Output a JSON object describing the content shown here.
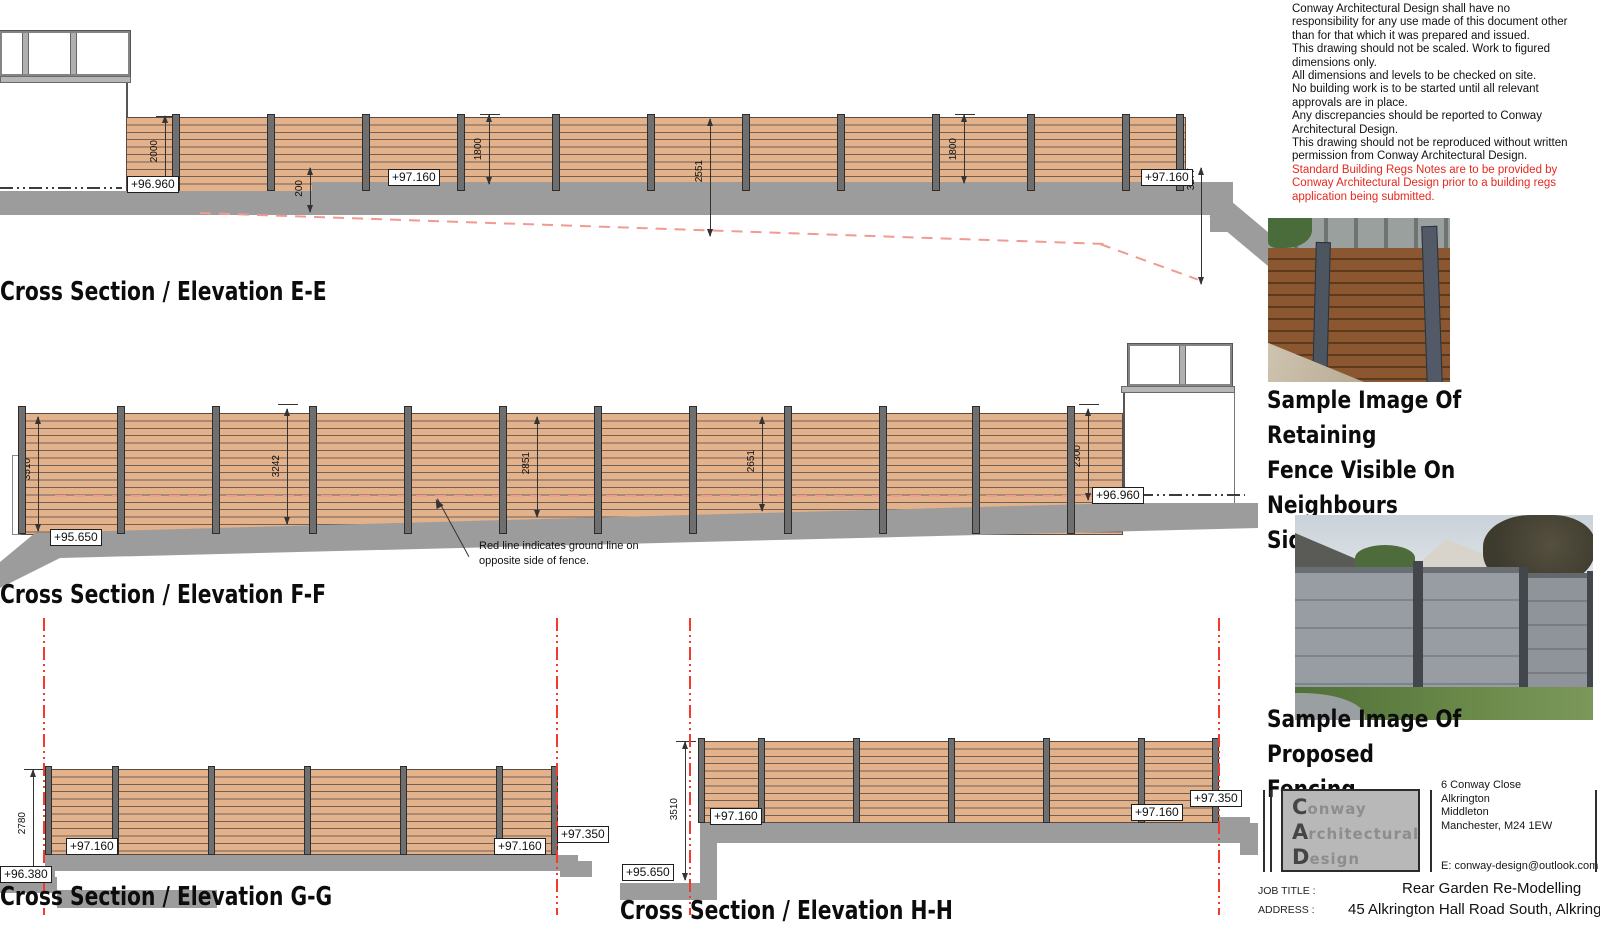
{
  "notes": {
    "disclaimer": "Conway Architectural Design shall have no\nresponsibility for any use made of this document other\nthan for that which it was prepared and issued.\nThis drawing should not be scaled. Work to figured\ndimensions only.\nAll dimensions and levels to be checked on site.\nNo building work is to be started until all relevant\napprovals are in place.\nAny discrepancies should be reported to Conway\nArchitectural Design.\nThis drawing should not be reproduced without written\npermission from Conway Architectural Design.",
    "building_regs": "Standard Building Regs Notes are to be provided by\nConway Architectural Design prior to a building regs\napplication being submitted."
  },
  "sections": [
    {
      "id": "E-E",
      "title": "Cross Section / Elevation E-E",
      "dims": [
        "2000",
        "200",
        "1800",
        "2551",
        "1800",
        "3277"
      ],
      "levels": [
        "+96.960",
        "+97.160",
        "+97.160"
      ]
    },
    {
      "id": "F-F",
      "title": "Cross Section / Elevation F-F",
      "dims": [
        "3510",
        "3242",
        "2851",
        "2651",
        "2300"
      ],
      "levels": [
        "+95.650",
        "+96.960"
      ],
      "note": "Red line indicates ground line on\nopposite side of fence."
    },
    {
      "id": "G-G",
      "title": "Cross Section / Elevation G-G",
      "dims": [
        "2780"
      ],
      "levels": [
        "+96.380",
        "+97.160",
        "+97.160",
        "+97.350"
      ]
    },
    {
      "id": "H-H",
      "title": "Cross Section / Elevation H-H",
      "dims": [
        "3510"
      ],
      "levels": [
        "+95.650",
        "+97.160",
        "+97.160",
        "+97.350"
      ]
    }
  ],
  "samples": [
    {
      "caption": "Sample Image Of Retaining\nFence  Visible On Neighbours\nSide"
    },
    {
      "caption": "Sample Image Of Proposed\nFencing"
    }
  ],
  "title_block": {
    "logo": [
      {
        "cap": "C",
        "rest": "onway"
      },
      {
        "cap": "A",
        "rest": "rchitectural"
      },
      {
        "cap": "D",
        "rest": "esign"
      }
    ],
    "office_address": "6 Conway Close\nAlkrington\nMiddleton\nManchester, M24 1EW",
    "email": "E:  conway-design@outlook.com",
    "job_title_label": "JOB TITLE :",
    "job_title": "Rear Garden Re-Modelling",
    "address_label": "ADDRESS :",
    "address": "45 Alkrington Hall Road South, Alkrington"
  },
  "colors": {
    "fence_fill": "#e3b28b",
    "fence_line": "#6f6058",
    "post": "#6f6f6f",
    "ground": "#9c9c9c",
    "red_construction": "#f43a2c",
    "red_ground_line": "#f09a92",
    "notes_red": "#e8281e"
  }
}
